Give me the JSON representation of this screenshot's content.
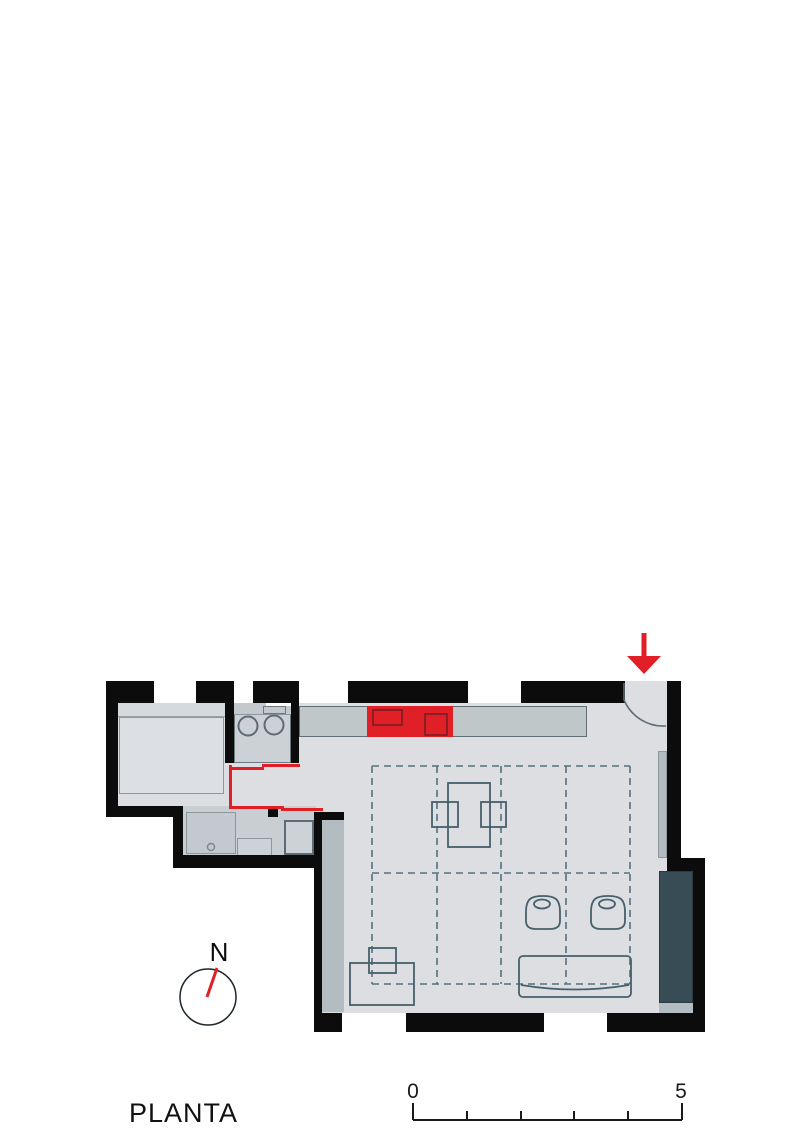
{
  "labels": {
    "title": "PLANTA",
    "north": "N",
    "scale_start": "0",
    "scale_end": "5"
  },
  "colors": {
    "wall": "#0c0c0c",
    "floor": "#dcdee2",
    "bathroom_floor": "#c8ced2",
    "kitchen_counter": "#bfc7c8",
    "accent_red": "#e11f26",
    "fixture_fill": "#ccd1d6",
    "wall_strip": "#b3bcc1",
    "dark_panel": "#374c55",
    "furniture_stroke": "#46606c",
    "ceiling_grid_dash": "#54707c"
  },
  "icons": {
    "entrance_arrow": "red-down-arrow",
    "north_compass": "circle-with-red-needle"
  }
}
